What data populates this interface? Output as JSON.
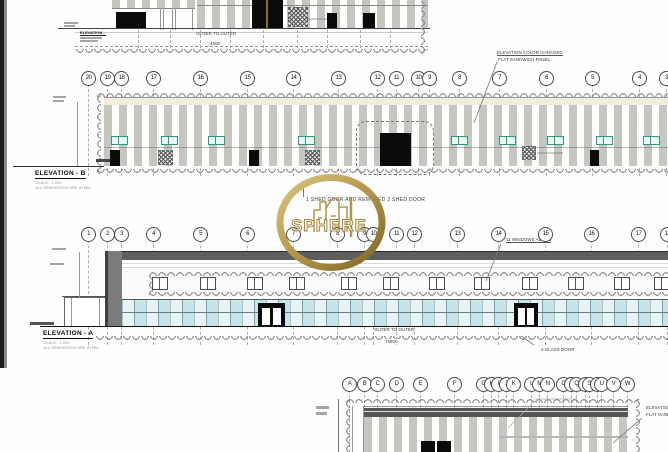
{
  "logo": {
    "text": "SPHERE"
  },
  "elevation_top": {
    "label": "ELEVATION - C",
    "scale_note": "SCALE : 1:200",
    "dims_note": "ALL DIMENSIONS ARE IN MM",
    "dim_label": "OUTER TO OUTER",
    "dim_value": "4500"
  },
  "elevation_b": {
    "label": "ELEVATION - B",
    "scale_note": "SCALE : 1:200",
    "dims_note": "ALL DIMENSIONS ARE IN MM",
    "annotation_color": {
      "line1": "ELEVATION COLOR CHNAGED",
      "line2": "FLAT SANDWICH PANEL"
    },
    "annotation_door": "1 SHED DOOR AND REMOVED 2 SHED DOOR",
    "grids": [
      {
        "label": "20",
        "x": 88
      },
      {
        "label": "19",
        "x": 107
      },
      {
        "label": "18",
        "x": 121
      },
      {
        "label": "17",
        "x": 153
      },
      {
        "label": "16",
        "x": 200
      },
      {
        "label": "15",
        "x": 247
      },
      {
        "label": "14",
        "x": 293
      },
      {
        "label": "13",
        "x": 338
      },
      {
        "label": "12",
        "x": 377
      },
      {
        "label": "11",
        "x": 396
      },
      {
        "label": "10",
        "x": 418
      },
      {
        "label": "9",
        "x": 429
      },
      {
        "label": "8",
        "x": 459
      },
      {
        "label": "7",
        "x": 499
      },
      {
        "label": "6",
        "x": 546
      },
      {
        "label": "5",
        "x": 592
      },
      {
        "label": "4",
        "x": 639
      },
      {
        "label": "3",
        "x": 666
      }
    ]
  },
  "elevation_a": {
    "label": "ELEVATION - A",
    "scale_note": "SCALE : 1:200",
    "dims_note": "ALL DIMENSIONS ARE IN MM",
    "annotation_windows": "11 WINDOWS ADDED",
    "annotation_glass": "2 GLASS DOOR",
    "dim_label": "OUTER TO OUTER",
    "dim_value": "75800",
    "grids": [
      {
        "label": "1",
        "x": 88
      },
      {
        "label": "2",
        "x": 107
      },
      {
        "label": "3",
        "x": 121
      },
      {
        "label": "4",
        "x": 153
      },
      {
        "label": "5",
        "x": 200
      },
      {
        "label": "6",
        "x": 247
      },
      {
        "label": "7",
        "x": 293
      },
      {
        "label": "8",
        "x": 337
      },
      {
        "label": "9",
        "x": 364
      },
      {
        "label": "10",
        "x": 373
      },
      {
        "label": "11",
        "x": 396
      },
      {
        "label": "12",
        "x": 414
      },
      {
        "label": "13",
        "x": 457
      },
      {
        "label": "14",
        "x": 498
      },
      {
        "label": "15",
        "x": 545
      },
      {
        "label": "16",
        "x": 591
      },
      {
        "label": "17",
        "x": 638
      },
      {
        "label": "18",
        "x": 667
      }
    ]
  },
  "elevation_bottom": {
    "annotation_color": {
      "line1": "ELEVATION COLOR CHNAGED",
      "line2": "FLAT SANDWICH PANEL"
    },
    "grids": [
      {
        "label": "A",
        "x": 349
      },
      {
        "label": "B",
        "x": 364
      },
      {
        "label": "C",
        "x": 377
      },
      {
        "label": "D",
        "x": 396
      },
      {
        "label": "E",
        "x": 420
      },
      {
        "label": "F",
        "x": 454
      },
      {
        "label": "G",
        "x": 483
      },
      {
        "label": "H",
        "x": 491
      },
      {
        "label": "I",
        "x": 498
      },
      {
        "label": "J",
        "x": 506
      },
      {
        "label": "K",
        "x": 513
      },
      {
        "label": "L",
        "x": 531
      },
      {
        "label": "M",
        "x": 539
      },
      {
        "label": "N",
        "x": 547
      },
      {
        "label": "O",
        "x": 563
      },
      {
        "label": "P",
        "x": 571
      },
      {
        "label": "Q",
        "x": 576
      },
      {
        "label": "R",
        "x": 585
      },
      {
        "label": "S",
        "x": 589
      },
      {
        "label": "T",
        "x": 597
      },
      {
        "label": "U",
        "x": 601
      },
      {
        "label": "V",
        "x": 613
      },
      {
        "label": "W",
        "x": 627
      }
    ]
  }
}
